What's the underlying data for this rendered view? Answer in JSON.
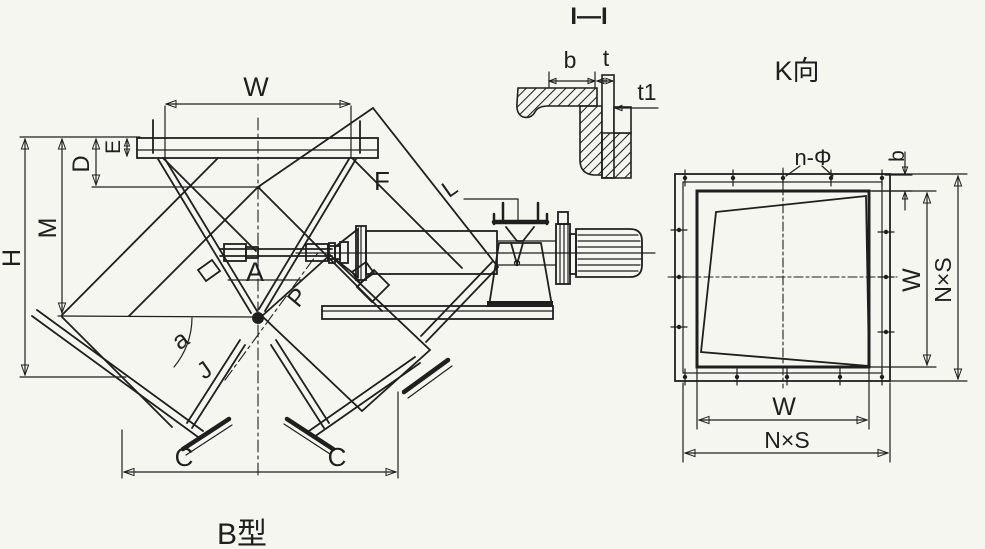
{
  "page": {
    "background": "#f6f6f1",
    "ink": "#1f1f1f",
    "description": "scanned engineering drawing of a B-type electric flap diverter valve"
  },
  "main_view": {
    "caption": "B型",
    "labels": {
      "W": "W",
      "E": "E",
      "D": "D",
      "M": "M",
      "H": "H",
      "F": "F",
      "L": "L",
      "A": "A",
      "P": "P",
      "angle_a": "a",
      "angle_j": "J",
      "C_left": "C",
      "C_right": "C"
    }
  },
  "section_view": {
    "title": "I—I",
    "labels": {
      "b": "b",
      "t": "t",
      "t1": "t1"
    }
  },
  "k_view": {
    "title": "K向",
    "labels": {
      "n_phi": "n-Φ",
      "b": "b",
      "W_right": "W",
      "NxS_right": "N×S",
      "W_bottom": "W",
      "NxS_bottom": "N×S"
    }
  }
}
